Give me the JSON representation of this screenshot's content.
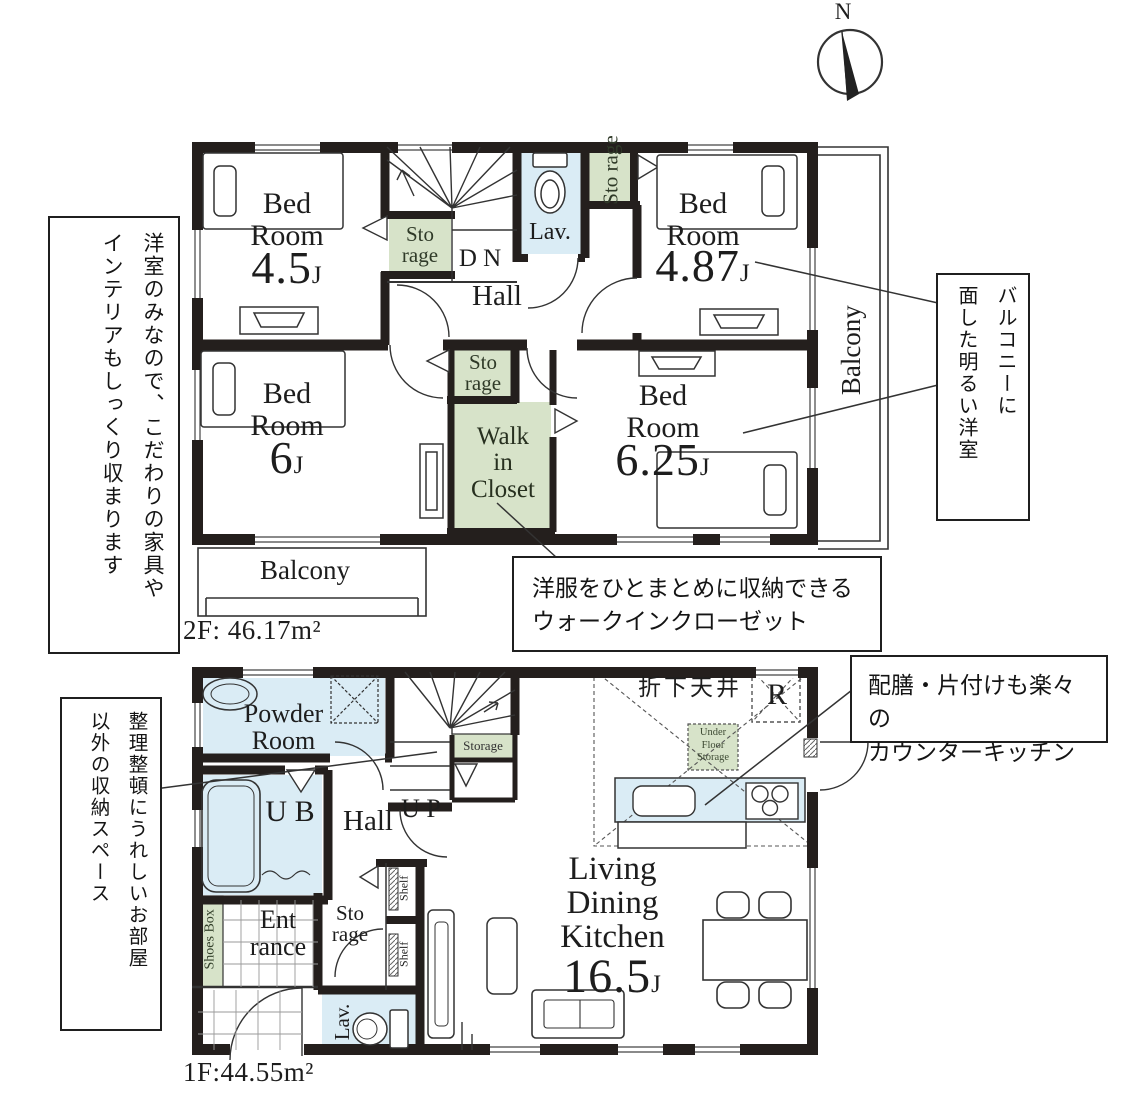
{
  "compass": {
    "label": "N"
  },
  "palette": {
    "storage_green": "#d7e3c9",
    "water_blue": "#daecf5",
    "wall_black": "#241f1d"
  },
  "floor2": {
    "area_label": "2F: 46.17m²",
    "left_note": {
      "line1": "洋室のみなので、こだわりの家具や",
      "line2": "インテリアもしっくり収まります"
    },
    "balcony_note": {
      "line1": "バルコニーに",
      "line2": "面した明るい洋室"
    },
    "closet_note": {
      "line1": "洋服をひとまとめに収納できる",
      "line2": "ウォークインクローゼット"
    },
    "rooms": {
      "bedroom45": {
        "name": "Bed Room",
        "size": "4.5",
        "unit": "J"
      },
      "bedroom487": {
        "name": "Bed Room",
        "size": "4.87",
        "unit": "J"
      },
      "bedroom6": {
        "name": "Bed Room",
        "size": "6",
        "unit": "J"
      },
      "bedroom625": {
        "name": "Bed Room",
        "size": "6.25",
        "unit": "J"
      },
      "hall": "Hall",
      "dn": "D N",
      "lav": "Lav.",
      "storage_hall": {
        "line1": "Sto",
        "line2": "rage"
      },
      "storage_top": {
        "line1": "Sto rage"
      },
      "storage_mid": {
        "line1": "Sto",
        "line2": "rage"
      },
      "wic": {
        "line1": "Walk",
        "line2": "in",
        "line3": "Closet"
      },
      "balcony_side": "Balcony",
      "balcony_bottom": "Balcony"
    }
  },
  "floor1": {
    "area_label": "1F:44.55m²",
    "left_note": {
      "line1": "整理整頓にうれしいお部屋",
      "line2": "以外の収納スペース"
    },
    "kitchen_note": {
      "line1": "配膳・片付けも楽々の",
      "line2": "カウンターキッチン"
    },
    "rooms": {
      "powder": {
        "line1": "Powder",
        "line2": "Room"
      },
      "ub": "U B",
      "hall": "Hall",
      "up": "U P",
      "stair_storage": "Storage",
      "dropped_ceiling": "折下天井",
      "fridge": "R",
      "underfloor": {
        "line1": "Under",
        "line2": "Floor",
        "line3": "Storage"
      },
      "ldk": {
        "line1": "Living",
        "line2": "Dining",
        "line3": "Kitchen",
        "size": "16.5",
        "unit": "J"
      },
      "storage": {
        "line1": "Sto",
        "line2": "rage"
      },
      "entrance": {
        "line1": "Ent",
        "line2": "rance"
      },
      "shoes_box": "Shoes Box",
      "shelf_upper": "Shelf",
      "shelf_lower": "Shelf",
      "lav": "Lav."
    }
  }
}
